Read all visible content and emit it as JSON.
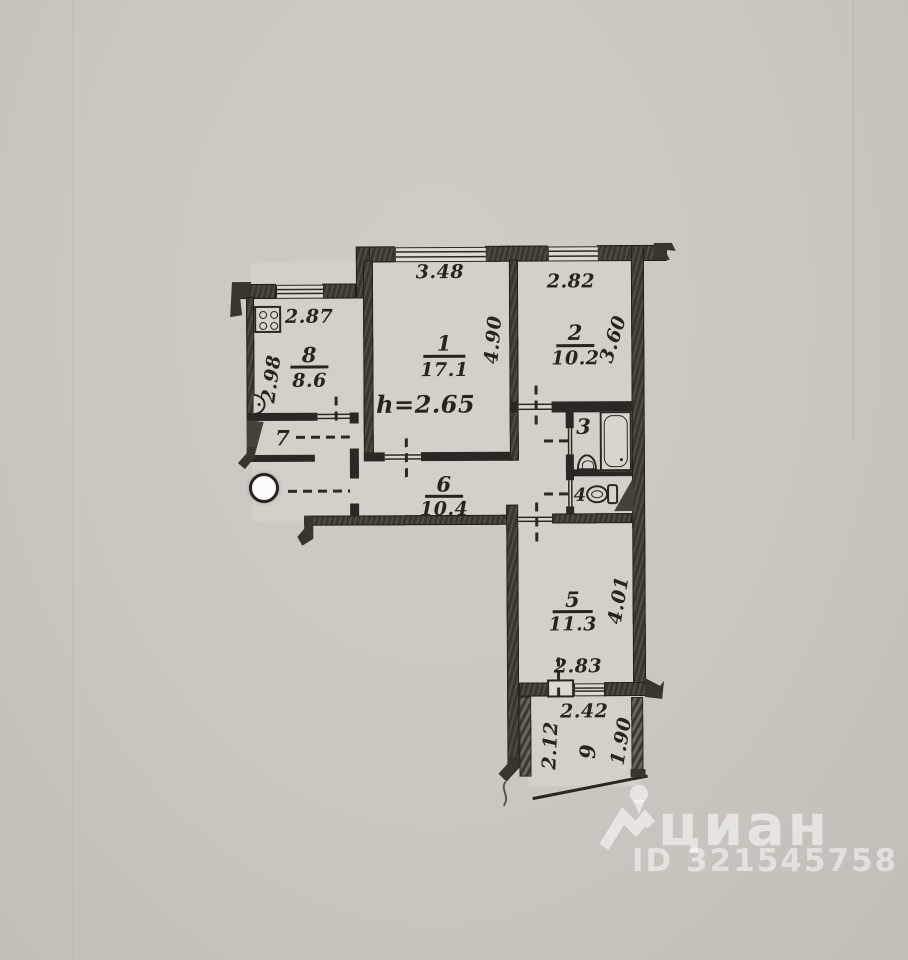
{
  "plan": {
    "height_note": "h=2.65",
    "rooms": [
      {
        "number": "1",
        "area": "17.1",
        "width": "3.48",
        "depth": "4.90"
      },
      {
        "number": "2",
        "area": "10.2",
        "width": "2.82",
        "depth": "3.60"
      },
      {
        "number": "3"
      },
      {
        "number": "4"
      },
      {
        "number": "5",
        "area": "11.3",
        "width": "2.83",
        "depth": "4.01"
      },
      {
        "number": "6",
        "area": "10.4"
      },
      {
        "number": "7"
      },
      {
        "number": "8",
        "area": "8.6",
        "width": "2.87",
        "depth": "2.98"
      },
      {
        "number": "9",
        "top_width": "2.42",
        "left_depth": "2.12",
        "right_depth": "1.90"
      }
    ],
    "icons": {
      "stove": "stove-icon",
      "kitchen_sink": "sink-icon",
      "bathtub": "bathtub-icon",
      "washbasin": "washbasin-icon",
      "toilet": "toilet-icon",
      "hole_punch": "hole-punch-mark"
    },
    "colors": {
      "paper": "#cbc6bf",
      "room_fill": "#d4cfc8",
      "ink": "#2b2722",
      "watermark": "rgba(255,255,255,0.55)"
    }
  },
  "watermark": {
    "brand": "циан",
    "listing_id": "ID 321545758"
  }
}
